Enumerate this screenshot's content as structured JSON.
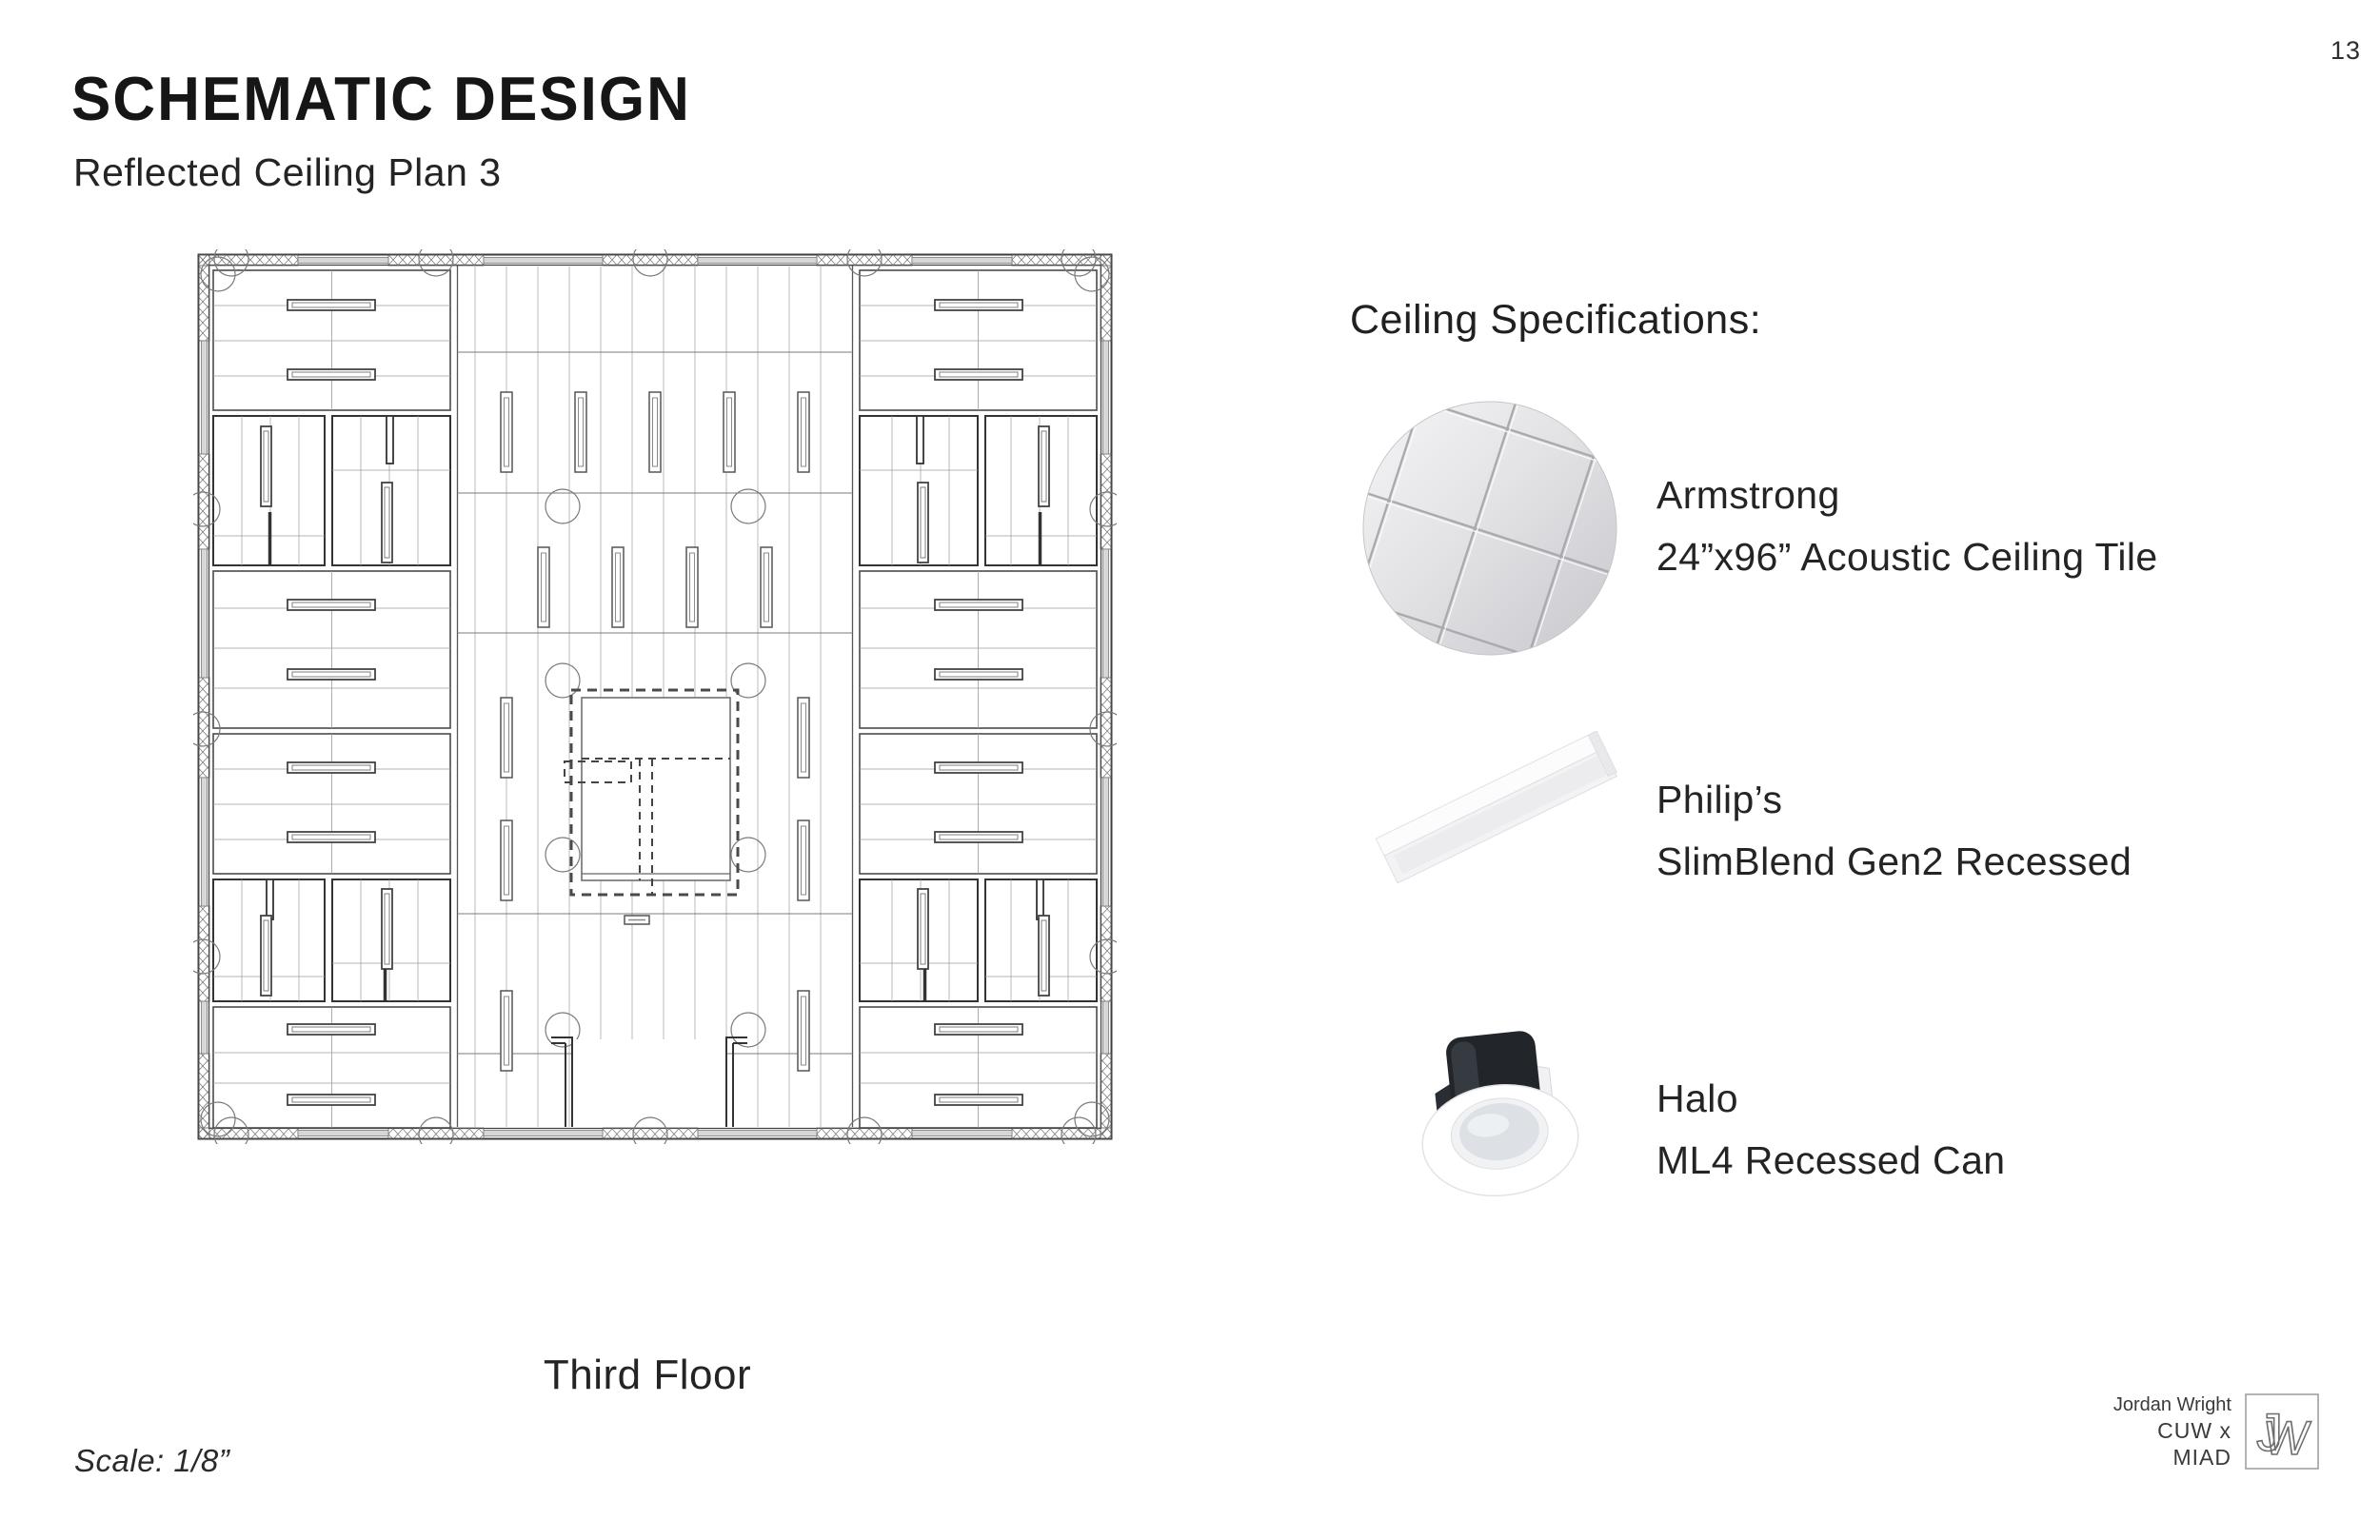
{
  "page": {
    "number": "13"
  },
  "header": {
    "title": "SCHEMATIC DESIGN",
    "subtitle": "Reflected Ceiling Plan 3"
  },
  "plan": {
    "caption": "Third Floor",
    "scale_note": "Scale: 1/8”",
    "drawing": "reflected-ceiling-plan-third-floor"
  },
  "specs": {
    "heading": "Ceiling Specifications:",
    "items": [
      {
        "image": "armstrong-tile-image",
        "brand": "Armstrong",
        "product": "24”x96” Acoustic Ceiling Tile"
      },
      {
        "image": "slimblend-panel-image",
        "brand": "Philip’s",
        "product": "SlimBlend Gen2 Recessed"
      },
      {
        "image": "halo-can-image",
        "brand": "Halo",
        "product": "ML4 Recessed Can"
      }
    ]
  },
  "credit": {
    "name": "Jordan Wright",
    "program": "CUW x MIAD",
    "logo_monogram": "JW",
    "logo_j": "J",
    "logo_w": "W"
  },
  "colors": {
    "text": "#1f1f1f",
    "plan_line_strong": "#4a4a4a",
    "plan_line_light": "#9b9b9b",
    "photo_gray": "#d9d9db"
  }
}
